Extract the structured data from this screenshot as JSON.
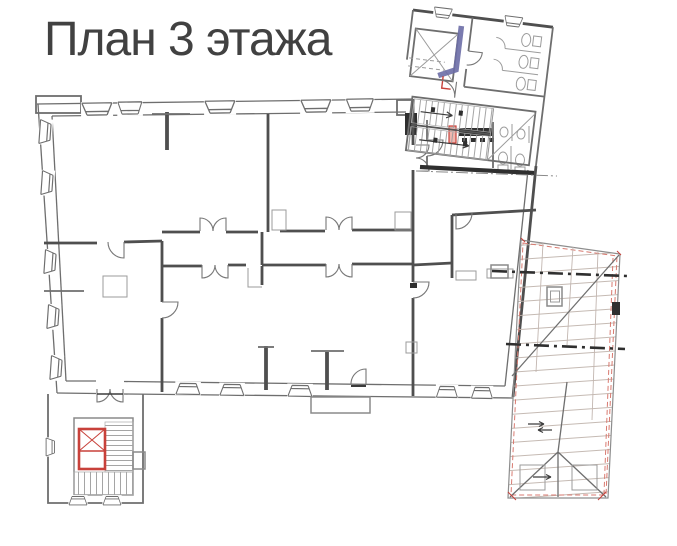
{
  "page": {
    "title": "План 3 этажа"
  },
  "colors": {
    "background": "#ffffff",
    "title": "#414141",
    "wall_dark": "#4f4f4f",
    "wall_medium": "#6e6e6e",
    "wall_light": "#9b9b9b",
    "accent_red": "#c8413a",
    "accent_red_light": "#d87a70",
    "accent_pink": "#f0b6ae",
    "accent_blue": "#6b6da6",
    "beam_dark": "#2f2f2f",
    "roof_line": "#b5a9a2"
  }
}
